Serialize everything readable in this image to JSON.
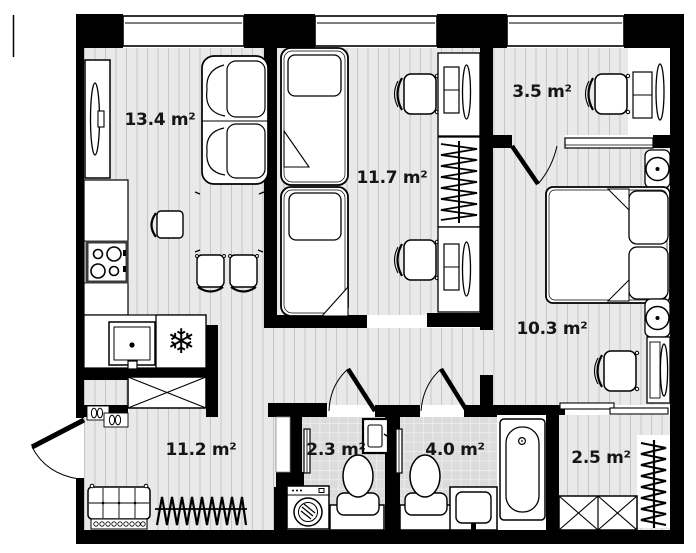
{
  "plan": {
    "type": "apartment-floor-plan",
    "colors": {
      "wall": "#000000",
      "floor_bg": "#e9e9e9",
      "floor_line": "#c6c6c6",
      "tile_bg": "#dcdcdc",
      "tile_line": "#f4f4f4",
      "furniture_fill": "#ffffff",
      "label_text": "#151515"
    },
    "rooms": [
      {
        "name": "living-kitchen",
        "label": "13.4 m²"
      },
      {
        "name": "kids-room",
        "label": "11.7 m²"
      },
      {
        "name": "dressing-room",
        "label": "3.5 m²"
      },
      {
        "name": "bedroom",
        "label": "10.3 m²"
      },
      {
        "name": "hallway",
        "label": "11.2 m²"
      },
      {
        "name": "wc",
        "label": "2.3 m²"
      },
      {
        "name": "bathroom",
        "label": "4.0 m²"
      },
      {
        "name": "closet",
        "label": "2.5 m²"
      }
    ],
    "icons": {
      "fridge_snowflake": "❄"
    },
    "window_count": 3
  }
}
